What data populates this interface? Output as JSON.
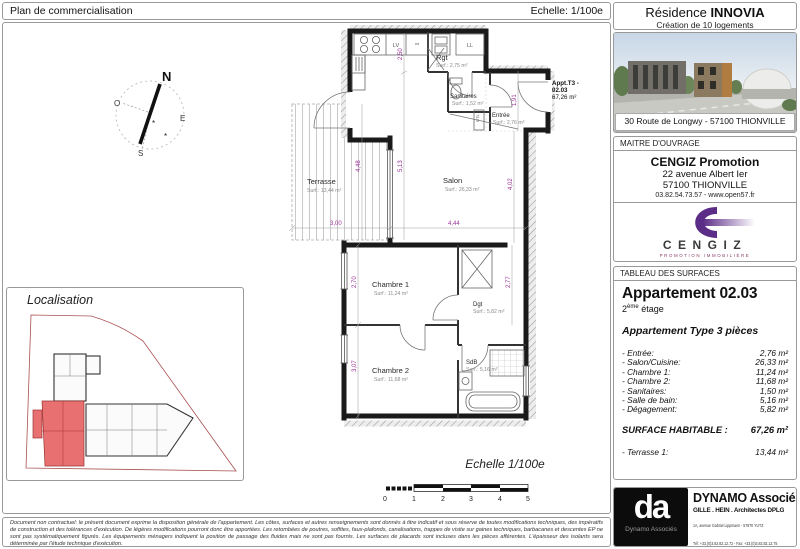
{
  "header": {
    "title": "Plan de commercialisation",
    "scale": "Echelle: 1/100e"
  },
  "residence": {
    "name_prefix": "Résidence ",
    "name": "INNOVIA",
    "subtitle": "Création de 10 logements",
    "address": "30 Route de Longwy - 57100 THIONVILLE"
  },
  "maitre_ouvrage": {
    "section_label": "MAITRE D'OUVRAGE",
    "company": "CENGIZ Promotion",
    "address_line1": "22 avenue Albert Ier",
    "address_line2": "57100 THIONVILLE",
    "contact": "03.82.54.73.57 - www.open57.fr",
    "logo_name": "CENGIZ",
    "logo_tagline": "PROMOTION IMMOBILIÈRE",
    "logo_color": "#5c2d87"
  },
  "surfaces_panel": {
    "section_label": "TABLEAU DES SURFACES",
    "apartment_title": "Appartement 02.03",
    "floor_num": "2",
    "floor_sup": "ème",
    "floor_rest": " étage",
    "type_label": "Appartement Type 3 pièces",
    "rooms": [
      {
        "label": "- Entrée:",
        "value": "2,76 m²"
      },
      {
        "label": "- Salon/Cuisine:",
        "value": "26,33 m²"
      },
      {
        "label": "- Chambre 1:",
        "value": "11,24 m²"
      },
      {
        "label": "- Chambre 2:",
        "value": "11,68 m²"
      },
      {
        "label": "- Sanitaires:",
        "value": "1,50 m²"
      },
      {
        "label": "- Salle de bain:",
        "value": "5,16 m²"
      },
      {
        "label": "- Dégagement:",
        "value": "5,82 m²"
      }
    ],
    "total_label": "SURFACE HABITABLE :",
    "total_value": "67,26 m²",
    "terrace_label": "- Terrasse 1:",
    "terrace_value": "13,44 m²"
  },
  "architect": {
    "logo_initials": "da",
    "logo_caption": "Dynamo Associés",
    "name": "DYNAMO Associés",
    "title_line": "GILLE . HEIN . Architectes DPLG",
    "address": "1A, avenue Gabriel Lippmann - 57970 YUTZ",
    "phones": "Tél: +33.(0)3.82.82.12.72 - Fax: +33.(0)3.82.82.12.75",
    "email": "contact @ dynamo-associes.fr"
  },
  "plan": {
    "appt_label_line1": "Appt.T3 -",
    "appt_label_line2": "02.03",
    "appt_label_line3": "67,26 m²",
    "rooms": {
      "terrasse": {
        "name": "Terrasse",
        "surf": "Surf.: 13,44 m²"
      },
      "salon": {
        "name": "Salon",
        "surf": "Surf.: 26,33 m²"
      },
      "rgt": {
        "name": "Rgt",
        "surf": "Surf.: 2,75 m²"
      },
      "sanitaires": {
        "name": "Sanitaires",
        "surf": "Surf.: 1,52 m²"
      },
      "entree": {
        "name": "Entrée",
        "surf": "Surf.: 2,76 m²"
      },
      "chambre1": {
        "name": "Chambre 1",
        "surf": "Surf.: 11,24 m²"
      },
      "dgt": {
        "name": "Dgt",
        "surf": "Surf.: 5,82 m²"
      },
      "chambre2": {
        "name": "Chambre 2",
        "surf": "Surf.: 11,68 m²"
      },
      "sdb": {
        "name": "SdB",
        "surf": "Surf.: 5,16 m²"
      }
    },
    "appliances": {
      "lv": "LV",
      "ll": "LL",
      "freezer_stars": "**",
      "gtl": "GTL"
    },
    "dims": {
      "d250": "2,50",
      "d448": "4,48",
      "d513": "5,13",
      "d402": "4,02",
      "d300": "3,00",
      "d444": "4,44",
      "d270": "2,70",
      "d277": "2,77",
      "d307": "3,07",
      "d191": "1,91"
    },
    "compass": {
      "n": "N",
      "o": "O",
      "e": "E",
      "s": "S"
    },
    "dim_color": "#993399"
  },
  "localisation": {
    "title": "Localisation",
    "highlight_color": "#e87070"
  },
  "scalebar": {
    "title": "Echelle 1/100e",
    "ticks": [
      "0",
      "1",
      "2",
      "3",
      "4",
      "5"
    ]
  },
  "legal": {
    "text": "Document non contractuel: le présent document exprime la disposition générale de l'appartement. Les côtes, surfaces et autres renseignements sont donnés à titre indicatif et sous réserve de toutes modifications techniques, des impératifs de construction et des tolérances d'exécution. De légères modifications pourront donc être apportées. Les retombées de poutres, soffites, faux-plafonds, canalisations, trappes de visite sur gaines techniques, barbacanes et descentes EP ne sont pas systématiquement figurés. Les équipements ménagers indiquent la position de passage des fluides mais ne sont pas fournis. Les surfaces de placards sont incluses dans les pièces afférentes. L'épaisseur des isolants sera déterminée par l'étude technique d'exécution."
  }
}
